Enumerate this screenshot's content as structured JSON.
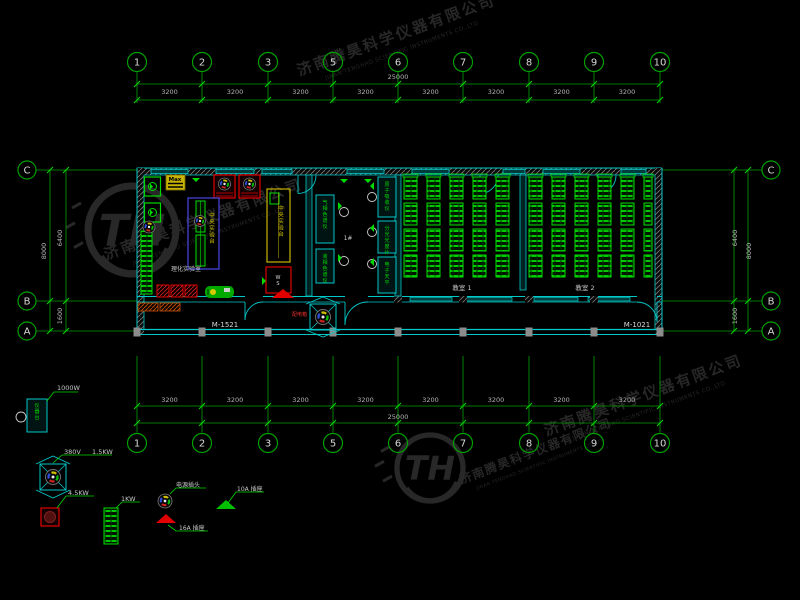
{
  "grid": {
    "top": {
      "bubbles": [
        "1",
        "2",
        "3",
        "5",
        "6",
        "7",
        "8",
        "9",
        "10"
      ],
      "bay_dims": [
        "3200",
        "3200",
        "3200",
        "3200",
        "3200",
        "3200",
        "3200",
        "3200"
      ],
      "total": "25000"
    },
    "bottom": {
      "bubbles": [
        "1",
        "2",
        "3",
        "5",
        "6",
        "7",
        "8",
        "9",
        "10"
      ],
      "bay_dims": [
        "3200",
        "3200",
        "3200",
        "3200",
        "3200",
        "3200",
        "3200",
        "3200"
      ],
      "total": "25000"
    },
    "left": {
      "bubbles": [
        "C",
        "B",
        "A"
      ],
      "span_dims": [
        "6400",
        "1600"
      ],
      "total": "8000"
    },
    "right": {
      "bubbles": [
        "C",
        "B",
        "A"
      ],
      "span_dims": [
        "6400",
        "1600"
      ],
      "total": "8000"
    }
  },
  "plan": {
    "door_tags": {
      "left": "M-1521",
      "right": "M-1021"
    },
    "rooms": {
      "lab": "理化实验室",
      "instrument": "1#",
      "room1": "教室 1",
      "room2": "教室 2"
    },
    "equipment": {
      "central_bench": "中央实验台",
      "side_bench": "中央实验台",
      "max_box": "Max",
      "ws": "WS",
      "power_box": "配电箱",
      "instruments": [
        "气相色谱仪",
        "液相色谱仪",
        "原子吸收仪",
        "分光光度计",
        "电子天平"
      ]
    }
  },
  "legend": {
    "instrument_table": {
      "power": "1000W",
      "label": "仪器台"
    },
    "dist_box": {
      "volt": "380V",
      "power": "1.5KW"
    },
    "oven": {
      "power": "4.5KW"
    },
    "cabinet": {
      "power": "1KW"
    },
    "plug": {
      "label": "电源插头"
    },
    "socket16": {
      "label": "16A 插座"
    },
    "socket10": {
      "label": "10A 插座"
    }
  },
  "watermark": {
    "cn": "济南腾昊科学仪器有限公司",
    "en": "JINAN TENGHAO SCIENTIFIC INSTRUMENTS CO.,LTD",
    "logo": "TH"
  },
  "colors": {
    "bg": "#000000",
    "grid": "#00A000",
    "bench": "#00DC00",
    "wall": "#00C8C8",
    "blue": "#4848E8",
    "yellow": "#C8B400",
    "red": "#E00000",
    "text": "#C8C8C8",
    "dim": "#B4B4B4",
    "watermark": "#272727"
  }
}
